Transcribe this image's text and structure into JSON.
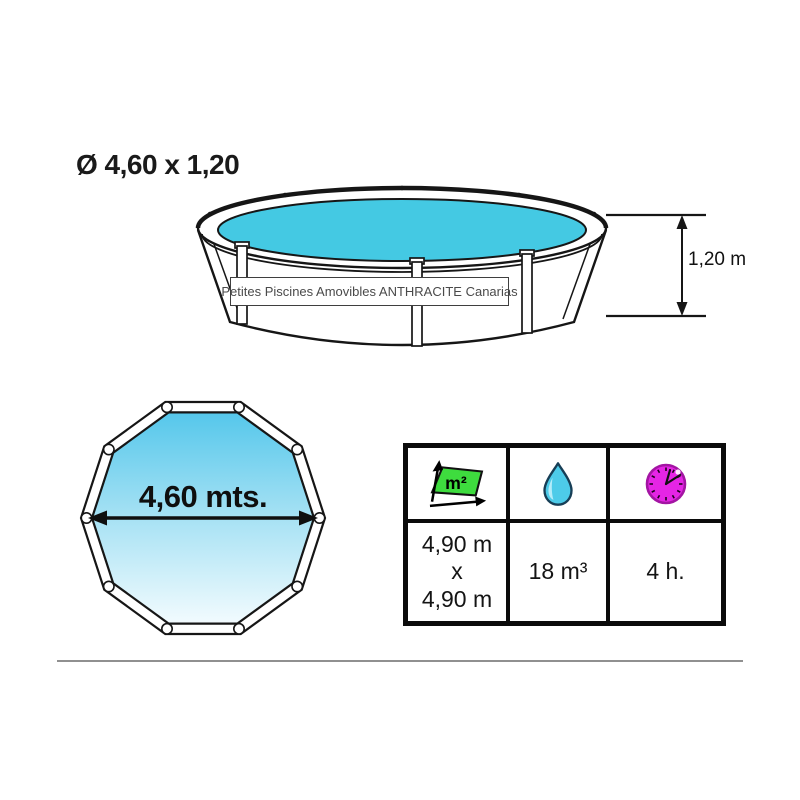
{
  "title": "Ø 4,60 x 1,20",
  "watermark": "Petites Piscines Amovibles ANTHRACITE Canarias",
  "side_view": {
    "height_value": "1,20 m"
  },
  "top_view": {
    "diameter_value": "4,60 mts."
  },
  "spec_table": {
    "area": {
      "icon": "area-m2-icon",
      "icon_text": "m²",
      "line1": "4,90 m",
      "line2": "x",
      "line3": "4,90 m"
    },
    "volume": {
      "icon": "water-drop-icon",
      "value": "18 m³"
    },
    "duration": {
      "icon": "clock-icon",
      "value": "4 h."
    }
  },
  "colors": {
    "water_cyan": "#44C9E3",
    "pool_gradient_top": "#55C7EB",
    "pool_gradient_bottom": "#F2FBFE",
    "area_icon_green": "#3EDC3E",
    "drop_cyan": "#4DCBE9",
    "clock_magenta": "#E525E5",
    "outline_black": "#161616",
    "divider_gray": "#909090",
    "watermark_text_gray": "#4A4A4A"
  }
}
